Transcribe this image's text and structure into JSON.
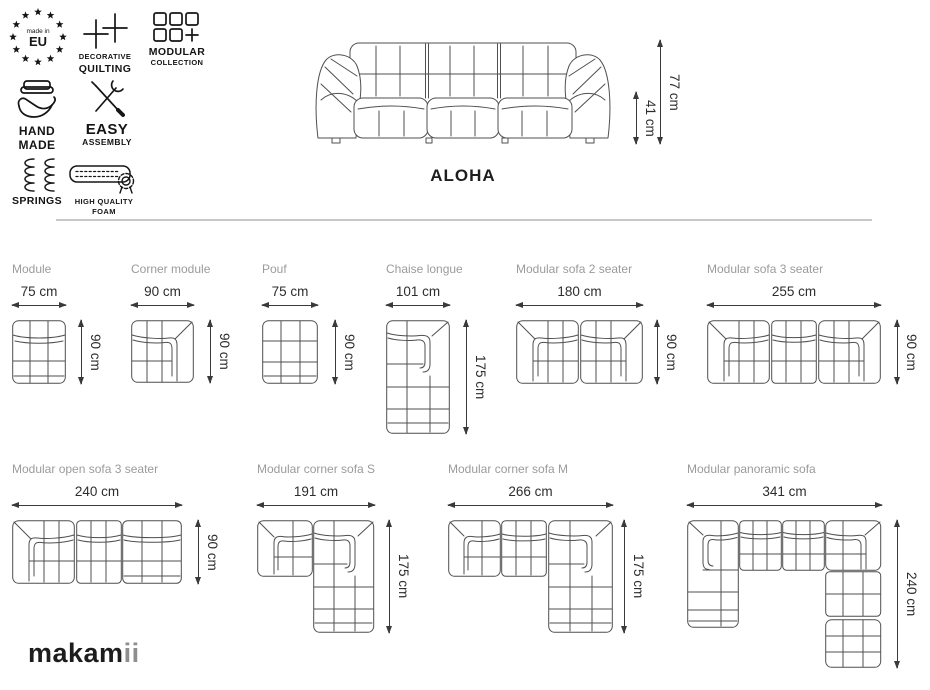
{
  "colors": {
    "title_grey": "#9b9b9b",
    "dimension_text": "#2d2d2d",
    "drawing_line": "#4f4f4f",
    "divider": "#c8c8c8",
    "logo_dark": "#1d1d1d",
    "logo_accent": "#8e8e8e"
  },
  "features": [
    {
      "icon": "made-in-eu-badge-icon",
      "lines": [
        "made in",
        "EU"
      ]
    },
    {
      "icon": "quilting-icon",
      "lines": [
        "DECORATIVE",
        "QUILTING"
      ]
    },
    {
      "icon": "modular-collection-icon",
      "lines": [
        "MODULAR",
        "COLLECTION"
      ]
    },
    {
      "icon": "hand-made-icon",
      "lines": [
        "HAND",
        "MADE"
      ]
    },
    {
      "icon": "easy-assembly-icon",
      "lines": [
        "EASY",
        "ASSEMBLY"
      ]
    },
    {
      "icon": "springs-icon",
      "lines": [
        "SPRINGS"
      ]
    },
    {
      "icon": "foam-icon",
      "lines": [
        "HIGH QUALITY",
        "FOAM"
      ]
    }
  ],
  "hero": {
    "name": "ALOHA",
    "total_height": "77 cm",
    "seat_height": "41 cm"
  },
  "modules": [
    {
      "name": "Module",
      "width": "75 cm",
      "depth": "90 cm"
    },
    {
      "name": "Corner module",
      "width": "90 cm",
      "depth": "90 cm"
    },
    {
      "name": "Pouf",
      "width": "75 cm",
      "depth": "90 cm"
    },
    {
      "name": "Chaise longue",
      "width": "101 cm",
      "depth": "175 cm"
    },
    {
      "name": "Modular sofa 2 seater",
      "width": "180 cm",
      "depth": "90 cm"
    },
    {
      "name": "Modular sofa 3 seater",
      "width": "255 cm",
      "depth": "90 cm"
    },
    {
      "name": "Modular open sofa 3 seater",
      "width": "240 cm",
      "depth": "90 cm"
    },
    {
      "name": "Modular corner sofa S",
      "width": "191 cm",
      "depth": "175 cm"
    },
    {
      "name": "Modular corner sofa M",
      "width": "266 cm",
      "depth": "175 cm"
    },
    {
      "name": "Modular panoramic sofa",
      "width": "341 cm",
      "depth": "240 cm"
    }
  ],
  "logo": {
    "main": "makam",
    "accent": "ii"
  }
}
